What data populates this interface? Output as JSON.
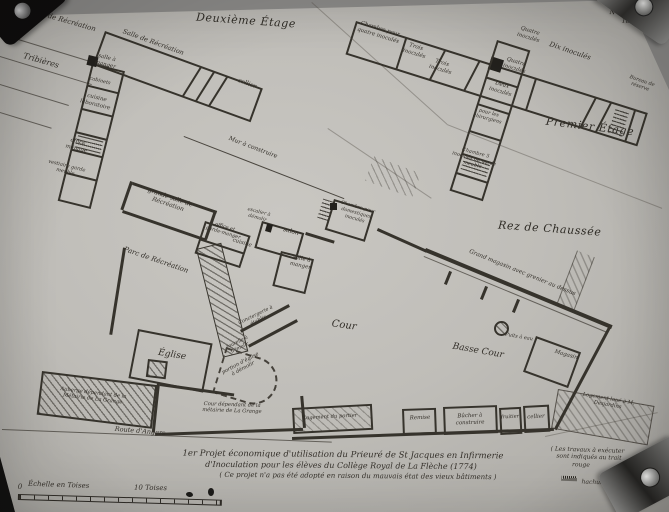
{
  "photo": {
    "archive_note": "N° 12 page 180"
  },
  "floors": {
    "second": {
      "title": "Deuxième Étage",
      "rooms": {
        "salle_recreation": "Salle de Récréation",
        "salle_a_manger": "salle à manger",
        "cabinets": "cabinets",
        "cuisine_laboratoire": "cuisine laboratoire",
        "office_menage": "office ménage",
        "vestiaire": "vestiaire garde meuble",
        "cellier": "cellier"
      },
      "surroundings": {
        "parc": "Parc de Récréation",
        "tribieres": "Tribières"
      }
    },
    "first": {
      "title": "Premier Étage",
      "rooms": {
        "chambre_quatre": "Chambre pour quatre inoculés",
        "trois_inocules_a": "Trois inoculés",
        "trois_inocules_b": "Trois inoculés",
        "quatre_inocules_a": "Quatre inoculés",
        "quatre_inocules_b": "Quatre inoculés",
        "deux_inocules": "Deux inoculés",
        "dix_inocules": "Dix inoculés",
        "bureau_reserve": "Bureau de réserve",
        "chirurgiens": "pour les chirurgiens",
        "chambre_cinq": "Chambre 5 inoculés ou garde meuble"
      }
    },
    "ground": {
      "title": "Rez de Chaussée",
      "rooms": {
        "grande_salle": "grande salle de Récréation",
        "office": "office et garde-manger",
        "cuisine": "cuisine",
        "escalier_demolir": "escalier à démolir",
        "salon": "salon",
        "salle_a_manger": "salle à manger",
        "chambre_domestiques": "Chambre pour domestiques inoculés",
        "conciergerie": "Conciergerie à établir",
        "tourelle": "tourelle à démolir",
        "portion_eglise": "portion d'église à démolir",
        "eglise": "Église",
        "magasin": "Magasin",
        "grand_magasin": "Grand magasin avec grenier au dessus",
        "puits": "Puits à eau",
        "remise": "Remise",
        "bucher": "Bûcher à construire",
        "fruitier": "fruitier",
        "cellier": "cellier",
        "logement_portier": "Logement du portier"
      },
      "surroundings": {
        "mur": "Mur à construire",
        "parc": "Parc de Récréation",
        "cour": "Cour",
        "basse_cour": "Basse Cour",
        "cour_metairie": "Cour dépendant de la métairie de La Grange",
        "auberge": "Auberge dépendant de la Métairie de La Grange",
        "route": "Route d'Angers",
        "logement_loue": "Logement loué à M. Desjardins"
      }
    }
  },
  "caption": {
    "line1": "1er Projet économique d'utilisation du Prieuré de St Jacques en Infirmerie",
    "line2": "d'Inoculation pour les élèves du Collège Royal de La Flèche (1774)",
    "line3": "( Ce projet n'a pas été adopté en raison du mauvais état des vieux bâtiments )"
  },
  "side_note": {
    "line1": "( Les travaux à exécuter",
    "line2": "sont indiqués au trait",
    "line3": "rouge",
    "line4": "hachuré )"
  },
  "scale_bar": {
    "zero": "0",
    "label": "Échelle en Toises",
    "ten": "10 Toises"
  }
}
